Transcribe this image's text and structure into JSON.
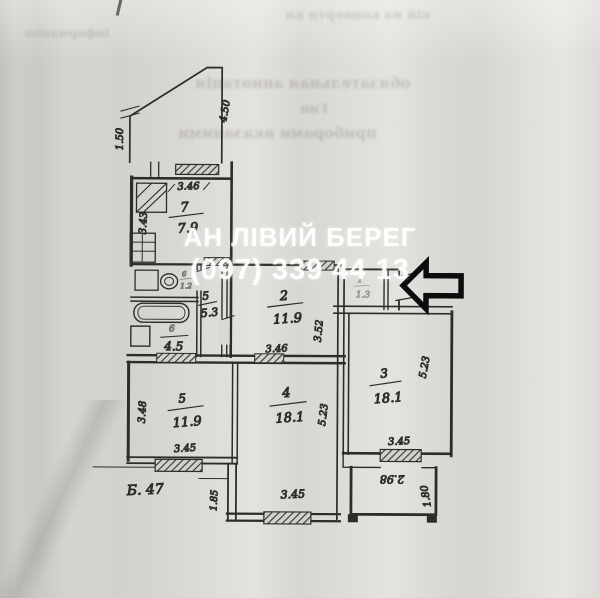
{
  "watermark": {
    "line1": "АН ЛІВИЙ БЕРЕГ",
    "line2": "(097) 339 44 13"
  },
  "plan": {
    "note_bottom_left": "Б. 47",
    "rooms": {
      "kitchen": {
        "number": "7",
        "area": "7.9"
      },
      "hall": {
        "number": "2",
        "area": "11.9"
      },
      "corridor": {
        "number": "5",
        "area": "5.3"
      },
      "bathroom": {
        "number": "6",
        "area": "4.5"
      },
      "toilet": {
        "number": "6",
        "area": "1.2"
      },
      "closet": {
        "number": "1",
        "area": "1.3"
      },
      "room3": {
        "number": "3",
        "area": "18.1"
      },
      "room4": {
        "number": "4",
        "area": "18.1"
      },
      "room5": {
        "number": "5",
        "area": "11.9"
      }
    },
    "dims": {
      "balcony_left": "1.50",
      "balcony_right": "4.50",
      "kitchen_top": "3.46",
      "kitchen_left": "3.43",
      "hall_bottom": "3.46",
      "hall_right": "3.52",
      "room5_left": "3.48",
      "room5_bottom": "3.45",
      "room4_right": "5.23",
      "room4_bottom": "3.45",
      "room4_left": "1.85",
      "room3_right": "5.23",
      "room3_bottom": "3.45",
      "balcony2_top": "2.98",
      "balcony2_right": "1.80"
    }
  },
  "bleed_through": {
    "line1": "вій на конверти ви",
    "line2": "обязательная аннотація",
    "line3": "Гип",
    "line4": "приборами вказаними",
    "line5": "інформацію"
  }
}
